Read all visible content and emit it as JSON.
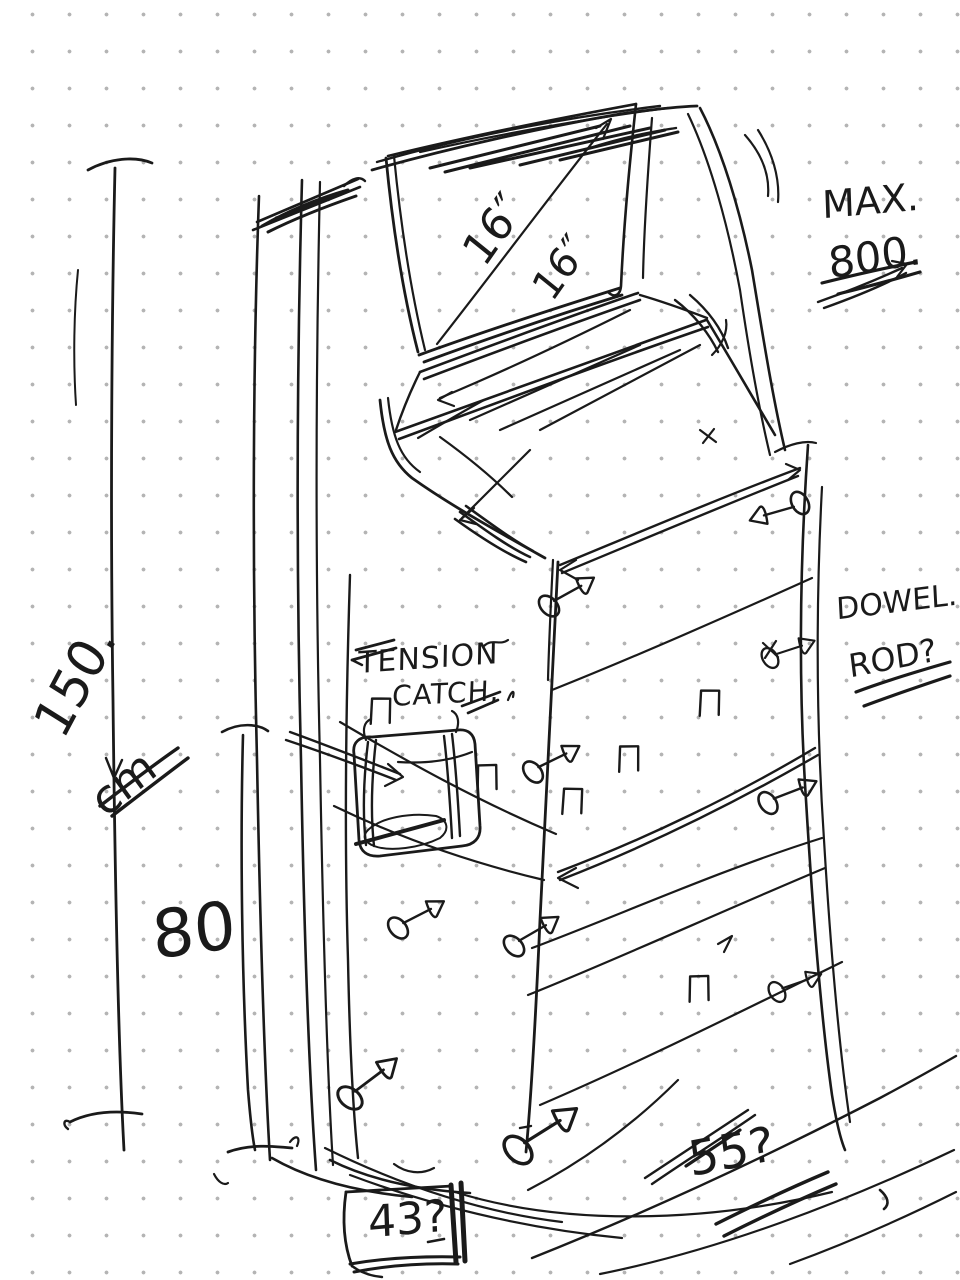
{
  "canvas": {
    "title": "hand-drawn cabinet design sketch on dotted grid paper",
    "paper_color": "#ffffff",
    "dot_color": "#b4b4b4",
    "ink_color": "#1a1a1a"
  },
  "annotations": {
    "max_label": "MAX.",
    "max_value": "800.",
    "screen_diagonal_a": "16″",
    "screen_diagonal_b": "16″",
    "height_value": "150.",
    "height_unit": "cm",
    "mid_width_value": "80",
    "tension_line1": "TENSION",
    "tension_line2": "CATCH,",
    "dowel_line1": "DOWEL.",
    "dowel_line2": "ROD?",
    "base_depth_value": "43?",
    "shelf_width_value": "55?"
  }
}
